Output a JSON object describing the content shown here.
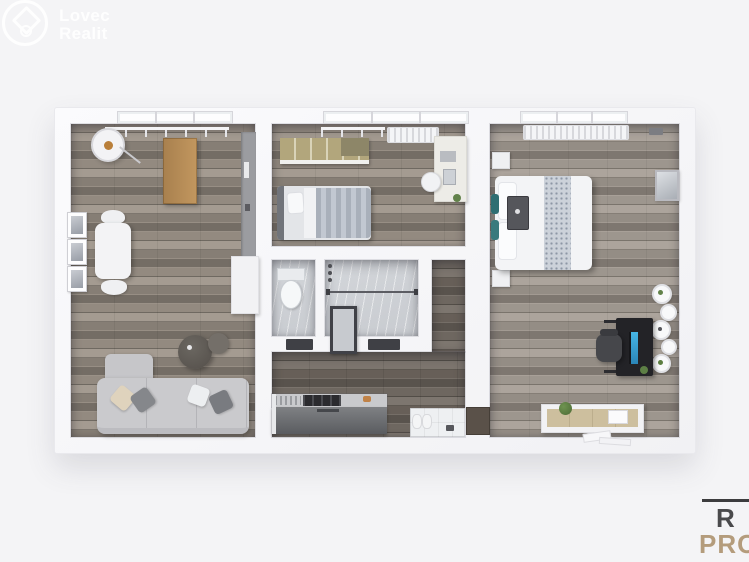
{
  "canvas": {
    "width": 749,
    "height": 562,
    "background": "#f4f4f6"
  },
  "brand": {
    "line1": "Lovec",
    "line2": "Realit",
    "icon": "circular-badge-with-diamond-house",
    "text_color": "#ffffff"
  },
  "watermark": {
    "rule_color": "#3c3c3e",
    "line1": "R",
    "line1_color": "#4a4a4c",
    "line2": "PRO",
    "line2_color": "#b49c7c"
  },
  "floorplan": {
    "style": "3D top-down apartment render",
    "wall_color": "#f8f8fa",
    "floor_colors": {
      "wood": "#8d857b",
      "wood_dark": "#665f58",
      "wood_light": "#979088",
      "marble": "#ced1d5",
      "entry_tile": "#eef0f2"
    },
    "rooms": [
      {
        "name": "living-room",
        "floor": "gray wood planks",
        "items": [
          "window",
          "curtain-rail",
          "floor-lamp",
          "oak-desk",
          "wall-frames-x3",
          "dining-table",
          "chairs-x2",
          "tall-gray-cabinet",
          "white-cabinet",
          "corner-sofa",
          "throw-pillows-x4",
          "round-coffee-tables-x2"
        ]
      },
      {
        "name": "small-bedroom",
        "floor": "gray wood planks",
        "items": [
          "window",
          "curtain-rail",
          "radiator",
          "wood-wardrobe",
          "single-bed-striped-duvet",
          "desk",
          "chair",
          "desk-plant"
        ]
      },
      {
        "name": "wc",
        "floor": "marble",
        "items": [
          "toilet"
        ]
      },
      {
        "name": "bathroom",
        "floor": "marble",
        "items": [
          "shower-fixtures",
          "glass-partition",
          "door-panel",
          "door-threshold"
        ]
      },
      {
        "name": "kitchen",
        "floor": "dark wood planks",
        "items": [
          "kitchen-counter",
          "cooktop",
          "sink-drainer",
          "entry-tile",
          "shoes",
          "doormat-item"
        ]
      },
      {
        "name": "hallway",
        "floor": "dark wood planks",
        "items": [
          "door-threshold-to-bedroom"
        ]
      },
      {
        "name": "master-bedroom",
        "floor": "gray wood planks",
        "items": [
          "window",
          "radiator-grille",
          "double-bed",
          "patterned-runner",
          "pillows",
          "teal-cushions",
          "bed-tray",
          "nightstands-x2",
          "wall-picture",
          "round-wall-shelves-x5",
          "computer-desk",
          "monitor",
          "office-chair",
          "sideboard",
          "plant",
          "books",
          "papers-on-floor"
        ]
      }
    ]
  }
}
